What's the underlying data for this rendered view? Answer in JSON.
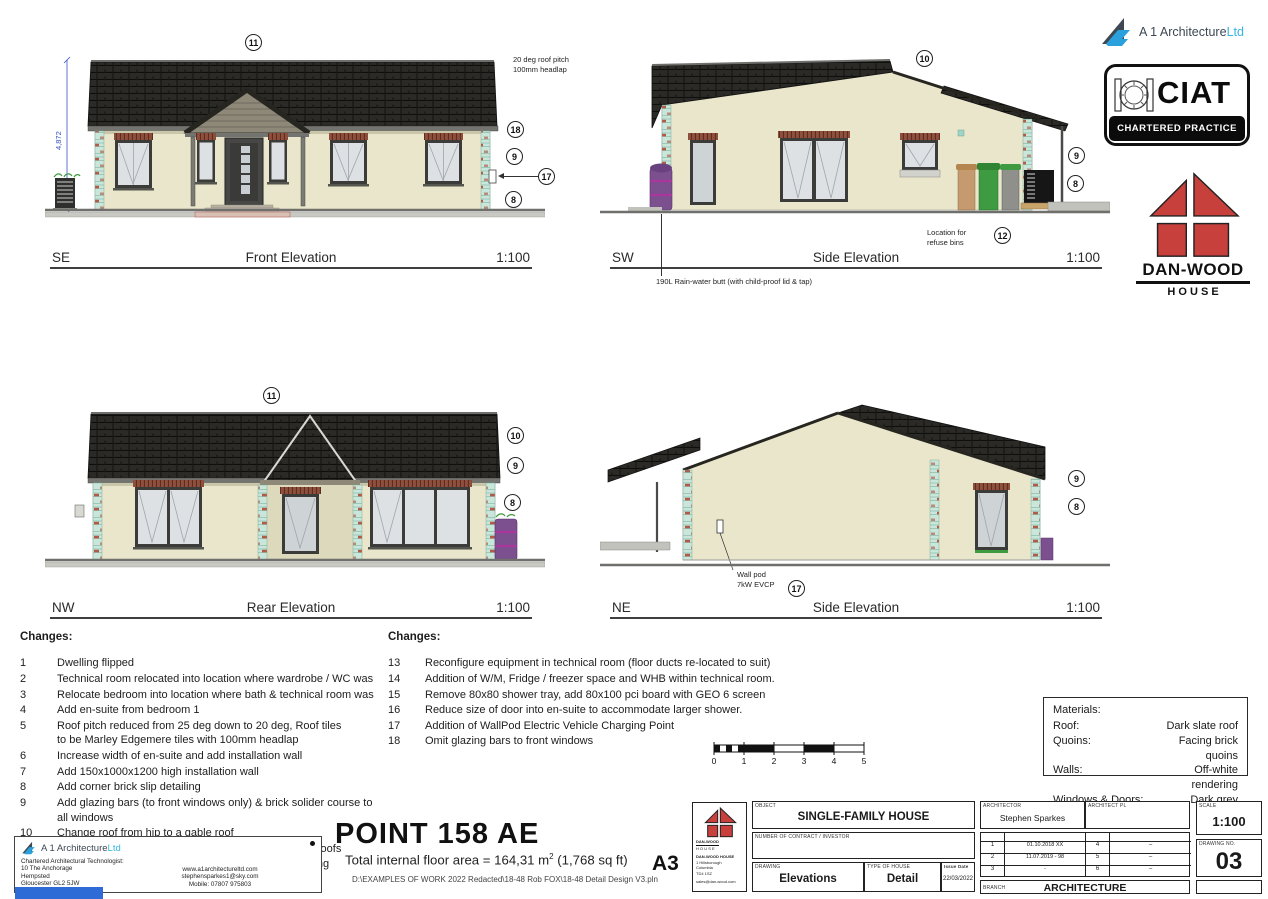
{
  "sheet": {
    "paper_size": "A3",
    "project_title": "POINT 158 AE",
    "floor_area_prefix": "Total internal floor area = 164,31 m",
    "floor_area_sup": "2",
    "floor_area_suffix": " (1,768 sq ft)",
    "file_path": "D:\\EXAMPLES OF WORK 2022 Redacted\\18-48 Rob FOX\\18-48 Detail Design V3.pln"
  },
  "logos": {
    "a1": {
      "brand": "A 1 Architecture",
      "suffix": "Ltd"
    },
    "ciat": {
      "acronym": "CIAT",
      "tagline": "CHARTERED PRACTICE"
    },
    "danwood": {
      "name": "DAN-WOOD",
      "word": "H O U S E"
    }
  },
  "elevations": [
    {
      "orientation": "SE",
      "title": "Front Elevation",
      "scale": "1:100",
      "markers": [
        "11",
        "18",
        "9",
        "17",
        "8"
      ],
      "roof_note": "20 deg roof pitch\n100mm headlap",
      "height_dim": "4,872"
    },
    {
      "orientation": "SW",
      "title": "Side Elevation",
      "scale": "1:100",
      "markers": [
        "10",
        "9",
        "8",
        "12"
      ],
      "refuse_note": "Location for\nrefuse bins",
      "rain_butt_note": "190L Rain-water butt (with child-proof lid & tap)"
    },
    {
      "orientation": "NW",
      "title": "Rear Elevation",
      "scale": "1:100",
      "markers": [
        "11",
        "10",
        "9",
        "8"
      ]
    },
    {
      "orientation": "NE",
      "title": "Side Elevation",
      "scale": "1:100",
      "markers": [
        "9",
        "8",
        "17"
      ],
      "wallpod_note": "Wall pod\n7kW EVCP"
    }
  ],
  "changes_left": {
    "heading": "Changes:",
    "items": [
      {
        "n": "1",
        "text": "Dwelling flipped"
      },
      {
        "n": "2",
        "text": "Technical room relocated into location where wardrobe / WC was"
      },
      {
        "n": "3",
        "text": "Relocate bedroom into location where bath & technical room was"
      },
      {
        "n": "4",
        "text": "Add en-suite from bedroom 1"
      },
      {
        "n": "5",
        "text": "Roof pitch reduced from 25 deg down to 20 deg, Roof tiles\nto be Marley Edgemere tiles with 100mm headlap"
      },
      {
        "n": "6",
        "text": "Increase width of en-suite and add installation wall"
      },
      {
        "n": "7",
        "text": "Add 150x1000x1200 high installation wall"
      },
      {
        "n": "8",
        "text": "Add corner brick slip detailing"
      },
      {
        "n": "9",
        "text": "Add glazing bars (to front windows only) & brick solider course to\nall windows"
      },
      {
        "n": "10",
        "text": "Change roof from hip to a gable roof"
      },
      {
        "n": "11",
        "text": "Add horz. timber cladding to front and rear projecting roofs"
      },
      {
        "n": "12",
        "text": "Add Air Source Heating Pack 6A with underfloor heating"
      }
    ]
  },
  "changes_right": {
    "heading": "Changes:",
    "items": [
      {
        "n": "13",
        "text": "Reconfigure equipment in technical room (floor ducts re-located to suit)"
      },
      {
        "n": "14",
        "text": "Addition of W/M, Fridge / freezer space and WHB within technical room."
      },
      {
        "n": "15",
        "text": "Remove 80x80 shower tray, add 80x100 pci board with GEO 6 screen"
      },
      {
        "n": "16",
        "text": "Reduce size of door into en-suite to accommodate larger shower."
      },
      {
        "n": "17",
        "text": "Addition of WallPod Electric Vehicle Charging Point"
      },
      {
        "n": "18",
        "text": "Omit glazing bars to front windows"
      }
    ]
  },
  "materials": {
    "heading": "Materials:",
    "rows": [
      {
        "label": "Roof:",
        "value": "Dark slate roof"
      },
      {
        "label": "Quoins:",
        "value": "Facing brick quoins"
      },
      {
        "label": "Walls:",
        "value": "Off-white rendering"
      },
      {
        "label": "Windows & Doors:",
        "value": "Dark grey PVC-u"
      }
    ]
  },
  "scale_bar": {
    "labels": [
      "0",
      "1",
      "2",
      "3",
      "4",
      "5"
    ]
  },
  "title_block": {
    "object_label": "OBJECT",
    "object": "SINGLE-FAMILY HOUSE",
    "contract_label": "NUMBER OF CONTRACT / INVESTOR",
    "drawing_label": "DRAWING",
    "drawing": "Elevations",
    "type_label": "TYPE OF HOUSE",
    "type": "Detail",
    "issue_label": "Issue Date",
    "issue_date": "22/03/2022",
    "architect_label": "ARCHITECTOR",
    "architect": "Stephen Sparkes",
    "architect_pl_label": "ARCHITECT PL",
    "version_label": "VERSION",
    "date_label": "DATE",
    "versions_left": [
      {
        "v": "1",
        "date": "01.10.2018 XX"
      },
      {
        "v": "2",
        "date": "11.07.2019 - 98"
      },
      {
        "v": "3",
        "date": "-"
      }
    ],
    "versions_right": [
      {
        "v": "4",
        "date": "–"
      },
      {
        "v": "5",
        "date": "–"
      },
      {
        "v": "6",
        "date": "–"
      }
    ],
    "scale_label": "SCALE",
    "scale": "1:100",
    "drawing_no_label": "DRAWING NO.",
    "drawing_no": "03",
    "branch_label": "BRANCH",
    "branch": "ARCHITECTURE",
    "danwood_mini_lines": [
      "DAN-WOOD",
      "H O U S E",
      "DAN-WOOD HOUSE",
      "1 Hillsborough",
      "Columbia",
      "TD4 1SZ",
      "sales@dan-wood.com"
    ]
  },
  "firm_block": {
    "brand": "A 1 Architecture",
    "suffix": "Ltd",
    "lines_left": [
      "Chartered Architectural Technologist:",
      "10 The Anchorage",
      "Hempsted",
      "Gloucester GL2 5JW",
      "Tel: 01452 413310"
    ],
    "lines_right": [
      "www.a1architectureltd.com",
      "stephensparkes1@sky.com",
      "Mobile: 07807 975803"
    ]
  }
}
